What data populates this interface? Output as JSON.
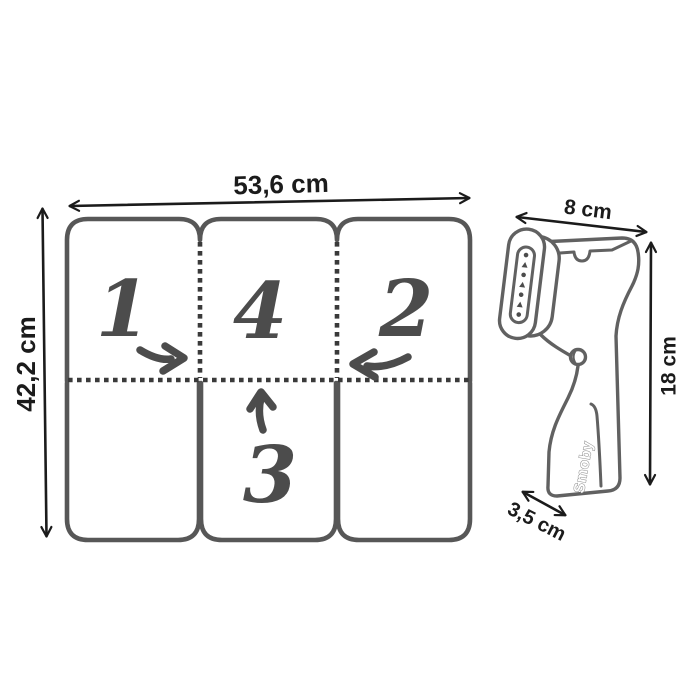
{
  "colors": {
    "background": "#ffffff",
    "board_outline": "#575757",
    "fold_dash": "#3a3a3a",
    "sketch_ink": "#4c4c4c",
    "dimension_ink": "#1b1b1b",
    "steamer_outline": "#616161"
  },
  "board": {
    "width_label": "53,6 cm",
    "height_label": "42,2 cm",
    "panels": {
      "top_left": "1",
      "top_middle": "4",
      "top_right": "2",
      "bottom_middle": "3"
    },
    "fold_arrow_icons": [
      "fold-right-arrow-icon",
      "fold-left-arrow-icon",
      "fold-up-arrow-icon"
    ]
  },
  "steamer": {
    "brand": "Smoby",
    "width_label": "8 cm",
    "height_label": "18 cm",
    "depth_label": "3,5 cm"
  }
}
